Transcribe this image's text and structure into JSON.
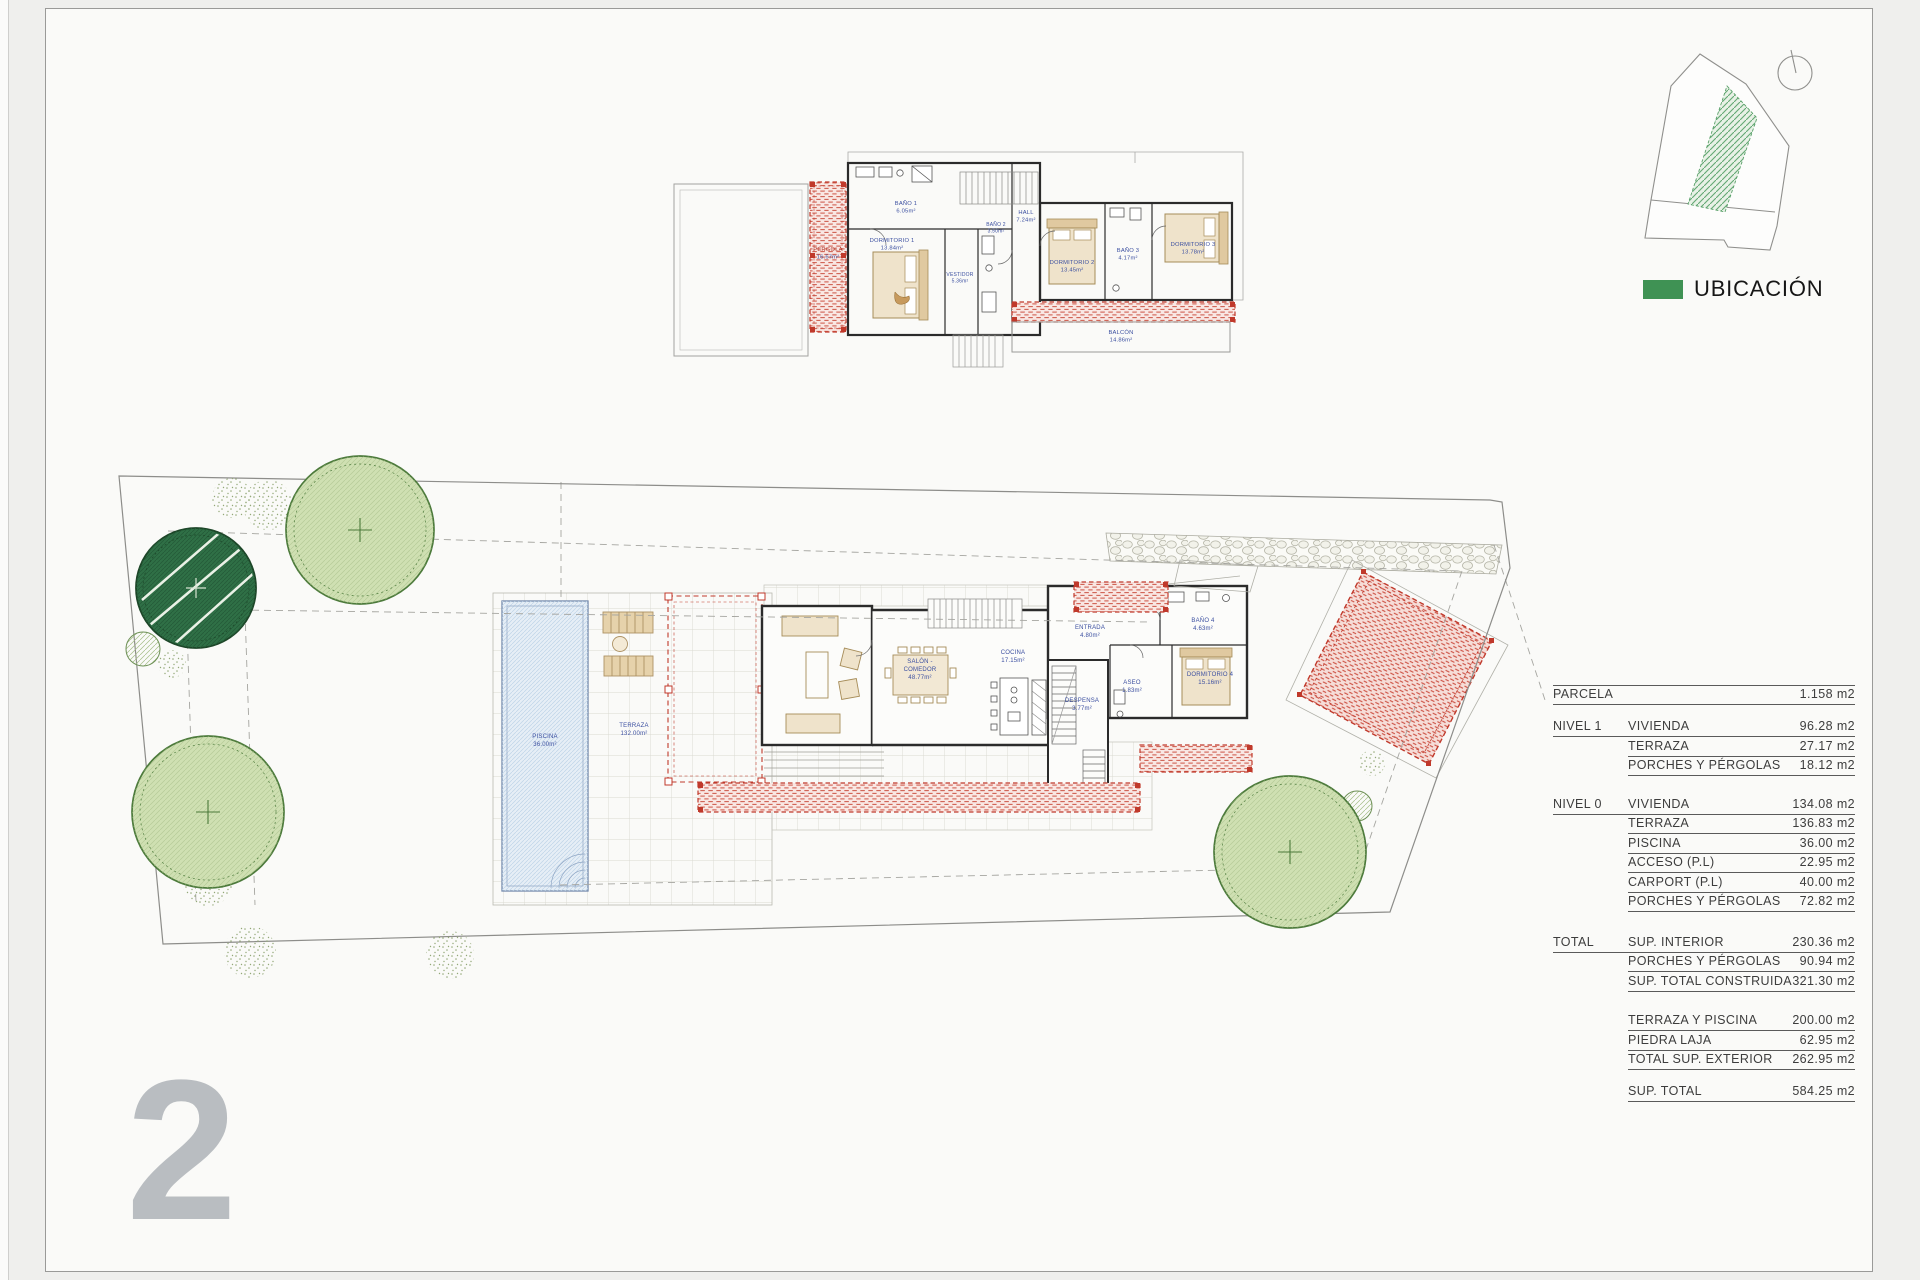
{
  "sheet": {
    "number": "2"
  },
  "legend": {
    "label": "UBICACIÓN",
    "accent_green": "#3F9254"
  },
  "areas_table": {
    "rows": [
      {
        "group": "PARCELA",
        "item": "",
        "value": "1.158 m2"
      },
      {
        "group": "NIVEL 1",
        "item": "VIVIENDA",
        "value": "96.28 m2"
      },
      {
        "group": "",
        "item": "TERRAZA",
        "value": "27.17 m2"
      },
      {
        "group": "",
        "item": "PORCHES Y PÉRGOLAS",
        "value": "18.12 m2"
      },
      {
        "group": "NIVEL 0",
        "item": "VIVIENDA",
        "value": "134.08 m2"
      },
      {
        "group": "",
        "item": "TERRAZA",
        "value": "136.83 m2"
      },
      {
        "group": "",
        "item": "PISCINA",
        "value": "36.00 m2"
      },
      {
        "group": "",
        "item": "ACCESO (P.L)",
        "value": "22.95 m2"
      },
      {
        "group": "",
        "item": "CARPORT (P.L)",
        "value": "40.00 m2"
      },
      {
        "group": "",
        "item": "PORCHES Y PÉRGOLAS",
        "value": "72.82 m2"
      },
      {
        "group": "TOTAL",
        "item": "SUP. INTERIOR",
        "value": "230.36 m2"
      },
      {
        "group": "",
        "item": "PORCHES Y PÉRGOLAS",
        "value": "90.94 m2"
      },
      {
        "group": "",
        "item": "SUP. TOTAL CONSTRUIDA",
        "value": "321.30 m2"
      },
      {
        "group": "",
        "item": "TERRAZA Y PISCINA",
        "value": "200.00 m2"
      },
      {
        "group": "",
        "item": "PIEDRA LAJA",
        "value": "62.95 m2"
      },
      {
        "group": "",
        "item": "TOTAL SUP. EXTERIOR",
        "value": "262.95 m2"
      },
      {
        "group": "",
        "item": "SUP. TOTAL",
        "value": "584.25 m2"
      }
    ]
  },
  "upper_plan": {
    "rooms": [
      {
        "name": "PÉRGOLA",
        "area": "16.67m²"
      },
      {
        "name": "BAÑO 1",
        "area": "6.05m²"
      },
      {
        "name": "DORMITORIO 1",
        "area": "13.84m²"
      },
      {
        "name": "VESTIDOR",
        "area": "5.36m²"
      },
      {
        "name": "BAÑO 2",
        "area": "3.50m²"
      },
      {
        "name": "HALL",
        "area": "7.24m²"
      },
      {
        "name": "DORMITORIO 2",
        "area": "13.45m²"
      },
      {
        "name": "BAÑO 3",
        "area": "4.17m²"
      },
      {
        "name": "DORMITORIO 3",
        "area": "13.78m²"
      },
      {
        "name": "BALCÓN",
        "area": "14.86m²"
      }
    ]
  },
  "ground_plan": {
    "salon": {
      "line1": "SALÓN -",
      "line2": "COMEDOR",
      "area": "48.77m²"
    },
    "rooms": [
      {
        "name": "COCINA",
        "area": "17.15m²"
      },
      {
        "name": "ENTRADA",
        "area": "4.80m²"
      },
      {
        "name": "BAÑO 4",
        "area": "4.63m²"
      },
      {
        "name": "DORMITORIO 4",
        "area": "15.16m²"
      },
      {
        "name": "ASEO",
        "area": "1.83m²"
      },
      {
        "name": "DESPENSA",
        "area": "3.77m²"
      },
      {
        "name": "PISCINA",
        "area": "36.00m²"
      },
      {
        "name": "TERRAZA",
        "area": "132.00m²"
      }
    ]
  }
}
